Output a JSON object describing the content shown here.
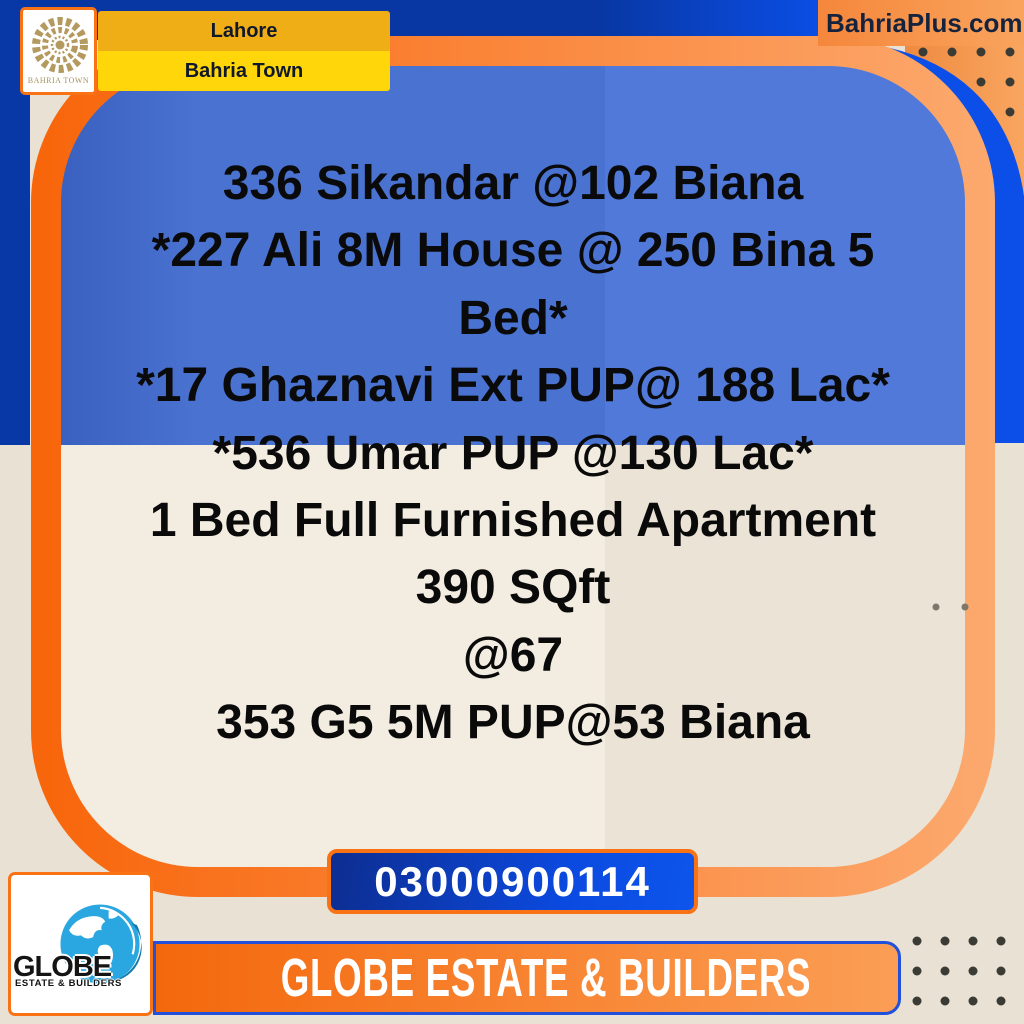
{
  "brand": {
    "logo_caption": "BAHRIA TOWN",
    "city": "Lahore",
    "community": "Bahria Town",
    "website": "BahriaPlus.com"
  },
  "listing": {
    "lines": [
      "336 Sikandar @102 Biana",
      "*227 Ali 8M House @ 250 Bina 5",
      "Bed*",
      "*17 Ghaznavi Ext PUP@ 188 Lac*",
      "*536 Umar PUP @130 Lac*",
      "1 Bed Full Furnished Apartment",
      "390 SQft",
      "@67",
      "353 G5 5M PUP@53 Biana"
    ]
  },
  "contact": {
    "phone": "03000900114"
  },
  "agency": {
    "banner": "GLOBE ESTATE & BUILDERS",
    "logo_name": "GLOBE",
    "logo_tagline": "ESTATE & BUILDERS"
  },
  "colors": {
    "dark_blue": "#0838a6",
    "bright_blue": "#0b4fe8",
    "panel_blue_left": "#4a72d0",
    "panel_blue_right": "#5079da",
    "cream_left": "#f2ece1",
    "cream_right": "#eae3d6",
    "outer_beige": "#e9e1d3",
    "orange_vivid": "#f8650a",
    "orange_light": "#fca96e",
    "yellow_top": "#f0ae16",
    "yellow_bottom": "#ffd60a",
    "gold": "#b59a60",
    "globe_blue": "#2aa7e0"
  }
}
